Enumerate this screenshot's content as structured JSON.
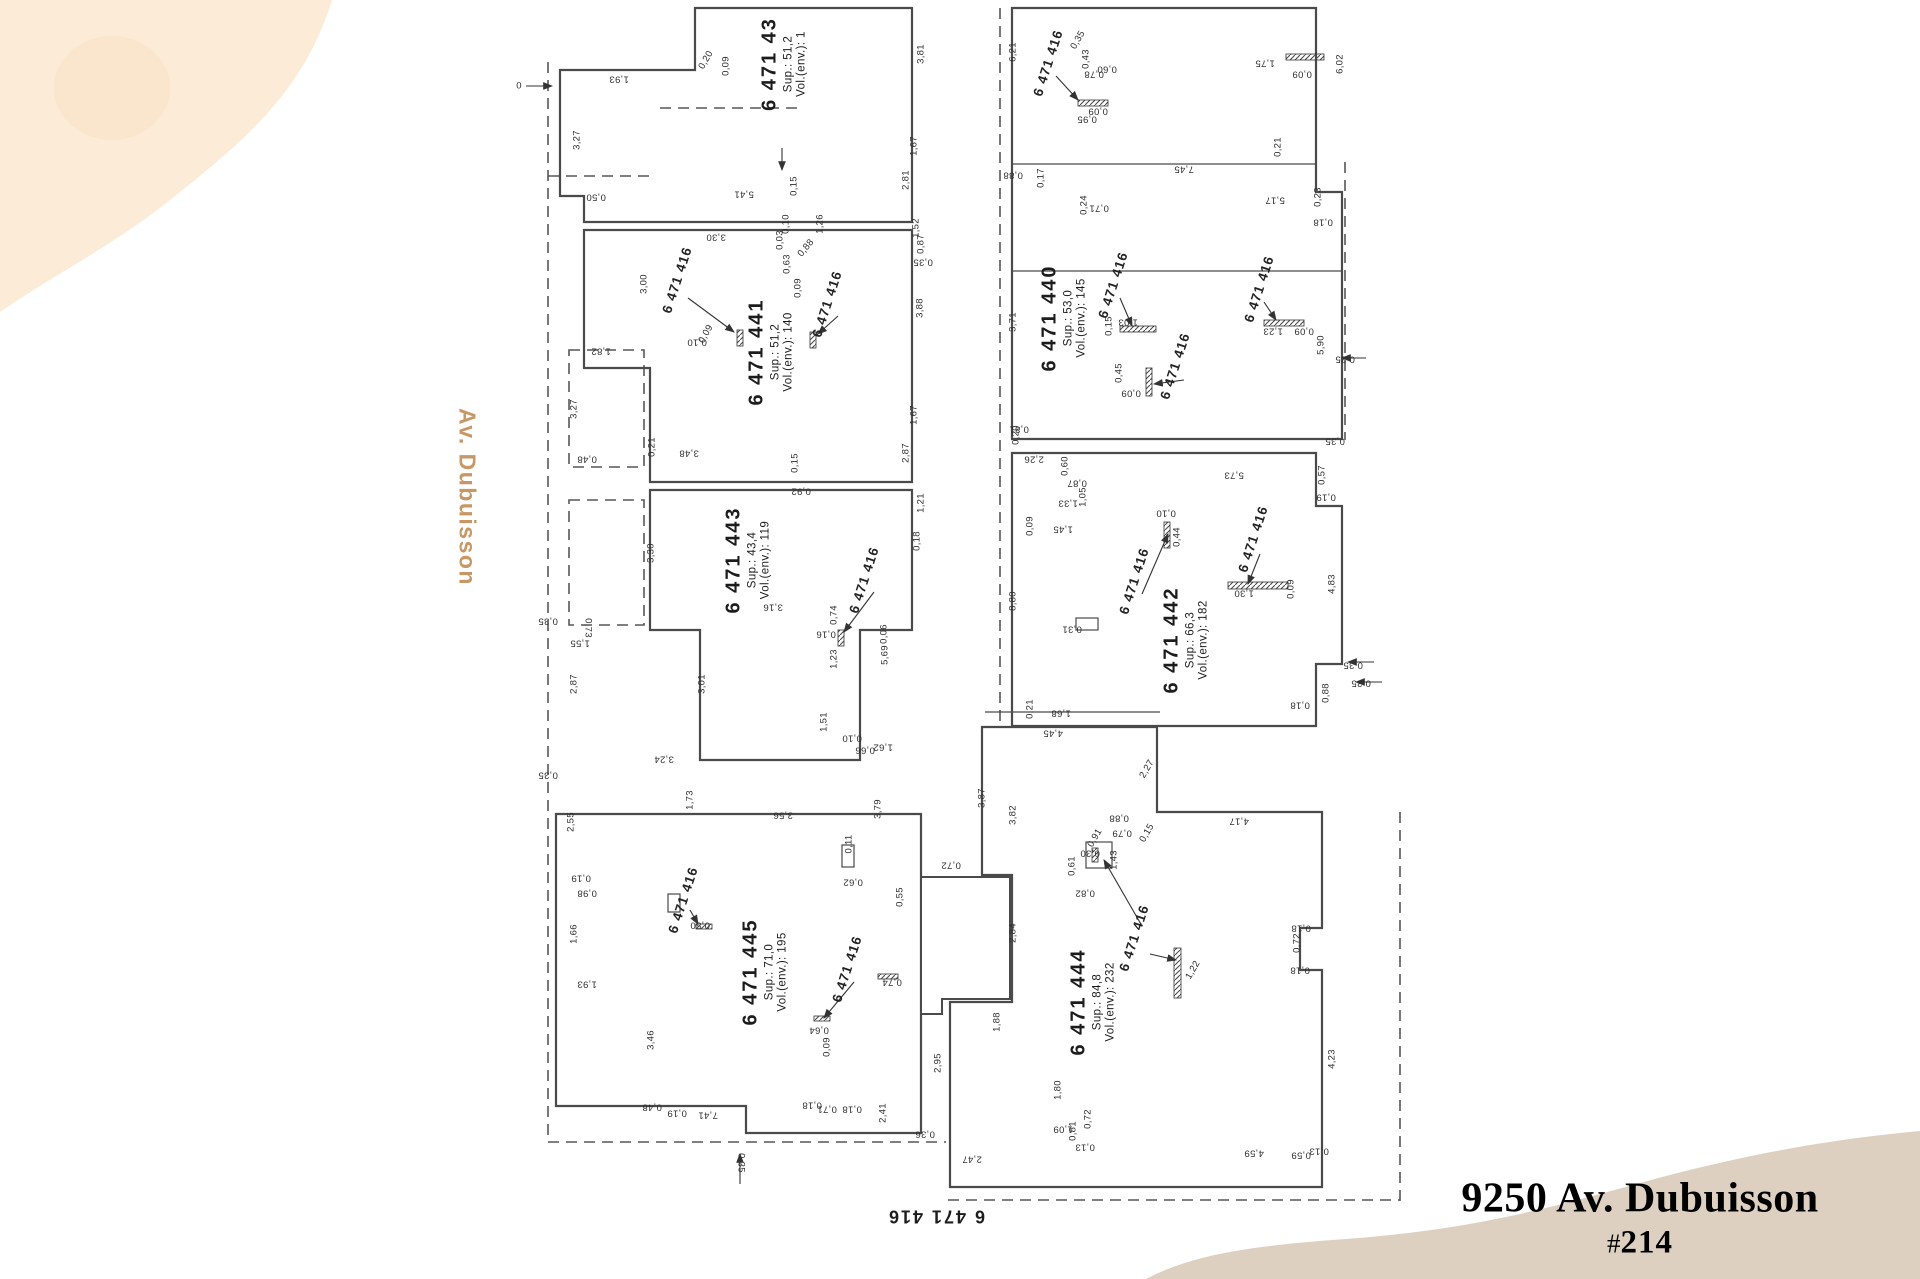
{
  "page": {
    "background": "#ffffff"
  },
  "decor": {
    "blob_top_color": "#fcebd6",
    "blob_top_inner": "#f8e2c6",
    "blob_bottom_color": "#ddd0c0"
  },
  "street_label": {
    "text": "Av. Dubuisson",
    "color": "#c79766"
  },
  "footer_lot": {
    "text": "6 471 416"
  },
  "title_block": {
    "address": "9250 Av. Dubuisson",
    "unit_prefix": "#",
    "unit_number": "214",
    "color": "#2c3d3f"
  },
  "plan": {
    "line_color": "#4a4a4a",
    "highlight_fill": "#eee1d3",
    "units": [
      {
        "number": "6 471 43",
        "sup": "Sup.: 51,2",
        "vol": "Vol.(env.): 1",
        "x": 783,
        "y": 64,
        "rot": -90
      },
      {
        "number": "6 471 441",
        "sup": "Sup.: 51,2",
        "vol": "Vol.(env.): 140",
        "x": 770,
        "y": 352,
        "rot": -90
      },
      {
        "number": "6 471 443",
        "sup": "Sup.: 43,4",
        "vol": "Vol.(env.): 119",
        "x": 747,
        "y": 560,
        "rot": -90
      },
      {
        "number": "6 471 445",
        "sup": "Sup.: 71,0",
        "vol": "Vol.(env.): 195",
        "x": 764,
        "y": 972,
        "rot": -90
      },
      {
        "number": "6 471 440",
        "sup": "Sup.: 53,0",
        "vol": "Vol.(env.): 145",
        "x": 1063,
        "y": 318,
        "rot": -90
      },
      {
        "number": "6 471 442",
        "sup": "Sup.: 66,3",
        "vol": "Vol.(env.): 182",
        "x": 1185,
        "y": 640,
        "rot": -90
      },
      {
        "number": "6 471 444",
        "sup": "Sup.: 84,8",
        "vol": "Vol.(env.): 232",
        "x": 1092,
        "y": 1002,
        "rot": -90
      }
    ],
    "wall_labels": [
      {
        "t": "6 471 416",
        "x": 677,
        "y": 280,
        "r": -72
      },
      {
        "t": "6 471 416",
        "x": 827,
        "y": 304,
        "r": -72
      },
      {
        "t": "6 471 416",
        "x": 864,
        "y": 580,
        "r": -72
      },
      {
        "t": "6 471 416",
        "x": 683,
        "y": 900,
        "r": -72
      },
      {
        "t": "6 471 416",
        "x": 847,
        "y": 969,
        "r": -72
      },
      {
        "t": "6 471 416",
        "x": 1048,
        "y": 63,
        "r": -72
      },
      {
        "t": "6 471 416",
        "x": 1113,
        "y": 285,
        "r": -72
      },
      {
        "t": "6 471 416",
        "x": 1175,
        "y": 366,
        "r": -72
      },
      {
        "t": "6 471 416",
        "x": 1259,
        "y": 289,
        "r": -72
      },
      {
        "t": "6 471 416",
        "x": 1134,
        "y": 581,
        "r": -72
      },
      {
        "t": "6 471 416",
        "x": 1253,
        "y": 539,
        "r": -72
      },
      {
        "t": "6 471 416",
        "x": 1134,
        "y": 938,
        "r": -72
      }
    ],
    "dims": [
      {
        "t": "0",
        "x": 519,
        "y": 86,
        "r": 0
      },
      {
        "t": "1,93",
        "x": 619,
        "y": 79,
        "r": 180
      },
      {
        "t": "3,27",
        "x": 577,
        "y": 140,
        "r": -90
      },
      {
        "t": "0,50",
        "x": 596,
        "y": 197,
        "r": 180
      },
      {
        "t": "5,41",
        "x": 744,
        "y": 194,
        "r": 180
      },
      {
        "t": "0,15",
        "x": 794,
        "y": 186,
        "r": -90
      },
      {
        "t": "2,81",
        "x": 906,
        "y": 180,
        "r": -90
      },
      {
        "t": "1,67",
        "x": 914,
        "y": 146,
        "r": -90
      },
      {
        "t": "3,81",
        "x": 921,
        "y": 54,
        "r": -90
      },
      {
        "t": "0,20",
        "x": 706,
        "y": 60,
        "r": -60
      },
      {
        "t": "0,09",
        "x": 726,
        "y": 66,
        "r": -90
      },
      {
        "t": "3,30",
        "x": 716,
        "y": 237,
        "r": 180
      },
      {
        "t": "0,10",
        "x": 786,
        "y": 224,
        "r": -90
      },
      {
        "t": "0,03",
        "x": 780,
        "y": 240,
        "r": -90
      },
      {
        "t": "0,63",
        "x": 787,
        "y": 264,
        "r": -90
      },
      {
        "t": "0,88",
        "x": 806,
        "y": 248,
        "r": -50
      },
      {
        "t": "0,09",
        "x": 798,
        "y": 288,
        "r": -90
      },
      {
        "t": "1,26",
        "x": 820,
        "y": 224,
        "r": -90
      },
      {
        "t": "1,52",
        "x": 916,
        "y": 228,
        "r": -90
      },
      {
        "t": "0,87",
        "x": 921,
        "y": 244,
        "r": -90
      },
      {
        "t": "0,35",
        "x": 923,
        "y": 262,
        "r": 180
      },
      {
        "t": "3,00",
        "x": 644,
        "y": 284,
        "r": -90
      },
      {
        "t": "0,09",
        "x": 706,
        "y": 334,
        "r": -60
      },
      {
        "t": "0,10",
        "x": 697,
        "y": 342,
        "r": 180
      },
      {
        "t": "1,82",
        "x": 601,
        "y": 351,
        "r": 180
      },
      {
        "t": "3,27",
        "x": 574,
        "y": 409,
        "r": -90
      },
      {
        "t": "0,48",
        "x": 587,
        "y": 459,
        "r": 180
      },
      {
        "t": "0,21",
        "x": 652,
        "y": 447,
        "r": -90
      },
      {
        "t": "3,48",
        "x": 689,
        "y": 453,
        "r": 180
      },
      {
        "t": "0,15",
        "x": 795,
        "y": 463,
        "r": -90
      },
      {
        "t": "2,87",
        "x": 906,
        "y": 453,
        "r": -90
      },
      {
        "t": "1,67",
        "x": 914,
        "y": 415,
        "r": -90
      },
      {
        "t": "3,88",
        "x": 920,
        "y": 308,
        "r": -90
      },
      {
        "t": "0,92",
        "x": 801,
        "y": 491,
        "r": 180
      },
      {
        "t": "1,21",
        "x": 921,
        "y": 503,
        "r": -90
      },
      {
        "t": "0,18",
        "x": 917,
        "y": 541,
        "r": -90
      },
      {
        "t": "3,30",
        "x": 651,
        "y": 553,
        "r": -90
      },
      {
        "t": "3,16",
        "x": 773,
        "y": 607,
        "r": 180
      },
      {
        "t": "0,74",
        "x": 834,
        "y": 615,
        "r": -90
      },
      {
        "t": "0,16",
        "x": 826,
        "y": 634,
        "r": 180
      },
      {
        "t": "0,06",
        "x": 884,
        "y": 634,
        "r": -90
      },
      {
        "t": "5,69",
        "x": 885,
        "y": 655,
        "r": -90
      },
      {
        "t": "1,23",
        "x": 834,
        "y": 659,
        "r": -90
      },
      {
        "t": "0,73",
        "x": 588,
        "y": 628,
        "r": 90
      },
      {
        "t": "1,55",
        "x": 580,
        "y": 643,
        "r": 180
      },
      {
        "t": "2,87",
        "x": 574,
        "y": 684,
        "r": -90
      },
      {
        "t": "3,01",
        "x": 702,
        "y": 684,
        "r": -90
      },
      {
        "t": "1,51",
        "x": 824,
        "y": 722,
        "r": -90
      },
      {
        "t": "0,10",
        "x": 852,
        "y": 738,
        "r": 180
      },
      {
        "t": "1,62",
        "x": 883,
        "y": 747,
        "r": 180
      },
      {
        "t": "0,66",
        "x": 865,
        "y": 750,
        "r": 180
      },
      {
        "t": "3,24",
        "x": 664,
        "y": 759,
        "r": 180
      },
      {
        "t": "0,35",
        "x": 548,
        "y": 775,
        "r": 180
      },
      {
        "t": "0,35",
        "x": 548,
        "y": 621,
        "r": 180
      },
      {
        "t": "1,73",
        "x": 690,
        "y": 800,
        "r": -90
      },
      {
        "t": "3,56",
        "x": 783,
        "y": 815,
        "r": 180
      },
      {
        "t": "3,79",
        "x": 878,
        "y": 809,
        "r": -90
      },
      {
        "t": "2,55",
        "x": 571,
        "y": 822,
        "r": -90
      },
      {
        "t": "0,19",
        "x": 581,
        "y": 878,
        "r": 180
      },
      {
        "t": "0,98",
        "x": 587,
        "y": 893,
        "r": 180
      },
      {
        "t": "1,66",
        "x": 574,
        "y": 934,
        "r": -90
      },
      {
        "t": "1,93",
        "x": 587,
        "y": 984,
        "r": 180
      },
      {
        "t": "3,46",
        "x": 651,
        "y": 1040,
        "r": -90
      },
      {
        "t": "0,48",
        "x": 652,
        "y": 1107,
        "r": 180
      },
      {
        "t": "0,19",
        "x": 677,
        "y": 1113,
        "r": 180
      },
      {
        "t": "7,41",
        "x": 708,
        "y": 1115,
        "r": 180
      },
      {
        "t": "0,18",
        "x": 812,
        "y": 1105,
        "r": 180
      },
      {
        "t": "0,71",
        "x": 827,
        "y": 1109,
        "r": 180
      },
      {
        "t": "0,18",
        "x": 852,
        "y": 1109,
        "r": 180
      },
      {
        "t": "2,41",
        "x": 883,
        "y": 1113,
        "r": -90
      },
      {
        "t": "0,50",
        "x": 700,
        "y": 925,
        "r": 180
      },
      {
        "t": "0,74",
        "x": 892,
        "y": 982,
        "r": 180
      },
      {
        "t": "0,64",
        "x": 819,
        "y": 1030,
        "r": 180
      },
      {
        "t": "0,09",
        "x": 827,
        "y": 1047,
        "r": -90
      },
      {
        "t": "0,11",
        "x": 849,
        "y": 844,
        "r": -90
      },
      {
        "t": "0,62",
        "x": 853,
        "y": 882,
        "r": 180
      },
      {
        "t": "0,55",
        "x": 900,
        "y": 897,
        "r": -90
      },
      {
        "t": "0,35",
        "x": 741,
        "y": 1163,
        "r": 90
      },
      {
        "t": "2,95",
        "x": 938,
        "y": 1063,
        "r": -90
      },
      {
        "t": "0,36",
        "x": 925,
        "y": 1134,
        "r": 180
      },
      {
        "t": "2,47",
        "x": 972,
        "y": 1159,
        "r": 180
      },
      {
        "t": "1,80",
        "x": 1058,
        "y": 1090,
        "r": -90
      },
      {
        "t": "1,09",
        "x": 1063,
        "y": 1129,
        "r": 180
      },
      {
        "t": "0,81",
        "x": 1073,
        "y": 1131,
        "r": -90
      },
      {
        "t": "0,72",
        "x": 1088,
        "y": 1119,
        "r": -90
      },
      {
        "t": "0,13",
        "x": 1085,
        "y": 1147,
        "r": 180
      },
      {
        "t": "4,59",
        "x": 1254,
        "y": 1153,
        "r": 180
      },
      {
        "t": "0,59",
        "x": 1301,
        "y": 1155,
        "r": 180
      },
      {
        "t": "0,13",
        "x": 1319,
        "y": 1151,
        "r": 180
      },
      {
        "t": "1,68",
        "x": 1061,
        "y": 713,
        "r": 180
      },
      {
        "t": "4,45",
        "x": 1053,
        "y": 733,
        "r": 180
      },
      {
        "t": "3,87",
        "x": 982,
        "y": 798,
        "r": -90
      },
      {
        "t": "2,27",
        "x": 1147,
        "y": 769,
        "r": -60
      },
      {
        "t": "0,88",
        "x": 1119,
        "y": 818,
        "r": 180
      },
      {
        "t": "0,79",
        "x": 1122,
        "y": 833,
        "r": 180
      },
      {
        "t": "0,15",
        "x": 1147,
        "y": 833,
        "r": -60
      },
      {
        "t": "0,91",
        "x": 1095,
        "y": 838,
        "r": -60
      },
      {
        "t": "0,30",
        "x": 1090,
        "y": 853,
        "r": 180
      },
      {
        "t": "1,43",
        "x": 1114,
        "y": 860,
        "r": -90
      },
      {
        "t": "0,61",
        "x": 1072,
        "y": 866,
        "r": -90
      },
      {
        "t": "0,82",
        "x": 1085,
        "y": 893,
        "r": 180
      },
      {
        "t": "4,17",
        "x": 1239,
        "y": 821,
        "r": 180
      },
      {
        "t": "1,22",
        "x": 1193,
        "y": 970,
        "r": -60
      },
      {
        "t": "0,18",
        "x": 1300,
        "y": 705,
        "r": 180
      },
      {
        "t": "0,18",
        "x": 1301,
        "y": 928,
        "r": 180
      },
      {
        "t": "0,72",
        "x": 1297,
        "y": 943,
        "r": -90
      },
      {
        "t": "0,18",
        "x": 1300,
        "y": 970,
        "r": 180
      },
      {
        "t": "2,84",
        "x": 1013,
        "y": 933,
        "r": -90
      },
      {
        "t": "1,88",
        "x": 997,
        "y": 1022,
        "r": -90
      },
      {
        "t": "3,82",
        "x": 1013,
        "y": 815,
        "r": -90
      },
      {
        "t": "0,72",
        "x": 951,
        "y": 865,
        "r": 180
      },
      {
        "t": "4,23",
        "x": 1332,
        "y": 1059,
        "r": -90
      },
      {
        "t": "0,21",
        "x": 1030,
        "y": 709,
        "r": -90
      },
      {
        "t": "6,21",
        "x": 1013,
        "y": 52,
        "r": -90
      },
      {
        "t": "0,35",
        "x": 1078,
        "y": 40,
        "r": -60
      },
      {
        "t": "0,43",
        "x": 1086,
        "y": 59,
        "r": -90
      },
      {
        "t": "0,78",
        "x": 1094,
        "y": 74,
        "r": 180
      },
      {
        "t": "0,60",
        "x": 1107,
        "y": 69,
        "r": 180
      },
      {
        "t": "0,09",
        "x": 1098,
        "y": 111,
        "r": 180
      },
      {
        "t": "0,95",
        "x": 1087,
        "y": 119,
        "r": 180
      },
      {
        "t": "1,75",
        "x": 1265,
        "y": 63,
        "r": 180
      },
      {
        "t": "0,09",
        "x": 1302,
        "y": 74,
        "r": 180
      },
      {
        "t": "6,02",
        "x": 1340,
        "y": 64,
        "r": -90
      },
      {
        "t": "0,88",
        "x": 1013,
        "y": 175,
        "r": 180
      },
      {
        "t": "0,17",
        "x": 1041,
        "y": 178,
        "r": -90
      },
      {
        "t": "7,45",
        "x": 1184,
        "y": 169,
        "r": 180
      },
      {
        "t": "0,21",
        "x": 1278,
        "y": 147,
        "r": -90
      },
      {
        "t": "5,17",
        "x": 1275,
        "y": 200,
        "r": 180
      },
      {
        "t": "0,24",
        "x": 1084,
        "y": 205,
        "r": -90
      },
      {
        "t": "0,71",
        "x": 1099,
        "y": 208,
        "r": 180
      },
      {
        "t": "0,23",
        "x": 1318,
        "y": 197,
        "r": -90
      },
      {
        "t": "0,18",
        "x": 1323,
        "y": 222,
        "r": 180
      },
      {
        "t": "3,71",
        "x": 1013,
        "y": 322,
        "r": -90
      },
      {
        "t": "1,03",
        "x": 1128,
        "y": 322,
        "r": 180
      },
      {
        "t": "0,15",
        "x": 1109,
        "y": 326,
        "r": -90
      },
      {
        "t": "0,45",
        "x": 1119,
        "y": 373,
        "r": -90
      },
      {
        "t": "0,09",
        "x": 1131,
        "y": 393,
        "r": 180
      },
      {
        "t": "1,23",
        "x": 1273,
        "y": 331,
        "r": 180
      },
      {
        "t": "0,09",
        "x": 1304,
        "y": 331,
        "r": 180
      },
      {
        "t": "5,90",
        "x": 1321,
        "y": 345,
        "r": -90
      },
      {
        "t": "0,20",
        "x": 1016,
        "y": 435,
        "r": -90
      },
      {
        "t": "0,81",
        "x": 1019,
        "y": 429,
        "r": 180
      },
      {
        "t": "2,26",
        "x": 1034,
        "y": 459,
        "r": 180
      },
      {
        "t": "0,35",
        "x": 1335,
        "y": 441,
        "r": 180
      },
      {
        "t": "0,60",
        "x": 1065,
        "y": 466,
        "r": -90
      },
      {
        "t": "0,87",
        "x": 1077,
        "y": 483,
        "r": 180
      },
      {
        "t": "1,05",
        "x": 1083,
        "y": 497,
        "r": -90
      },
      {
        "t": "1,33",
        "x": 1068,
        "y": 503,
        "r": 180
      },
      {
        "t": "1,45",
        "x": 1063,
        "y": 529,
        "r": 180
      },
      {
        "t": "0,09",
        "x": 1030,
        "y": 526,
        "r": -90
      },
      {
        "t": "5,73",
        "x": 1234,
        "y": 475,
        "r": 180
      },
      {
        "t": "0,57",
        "x": 1322,
        "y": 475,
        "r": -90
      },
      {
        "t": "0,19",
        "x": 1326,
        "y": 497,
        "r": 180
      },
      {
        "t": "0,44",
        "x": 1177,
        "y": 537,
        "r": -90
      },
      {
        "t": "0,10",
        "x": 1166,
        "y": 513,
        "r": 180
      },
      {
        "t": "1,30",
        "x": 1244,
        "y": 593,
        "r": 180
      },
      {
        "t": "0,09",
        "x": 1291,
        "y": 589,
        "r": -90
      },
      {
        "t": "4,83",
        "x": 1332,
        "y": 584,
        "r": -90
      },
      {
        "t": "8,80",
        "x": 1013,
        "y": 601,
        "r": -90
      },
      {
        "t": "0,31",
        "x": 1072,
        "y": 629,
        "r": 180
      },
      {
        "t": "0,88",
        "x": 1326,
        "y": 693,
        "r": -90
      },
      {
        "t": "0,35",
        "x": 1353,
        "y": 665,
        "r": 180
      },
      {
        "t": "0,35",
        "x": 1361,
        "y": 683,
        "r": 180
      },
      {
        "t": "0,35",
        "x": 1345,
        "y": 359,
        "r": 180
      }
    ]
  }
}
